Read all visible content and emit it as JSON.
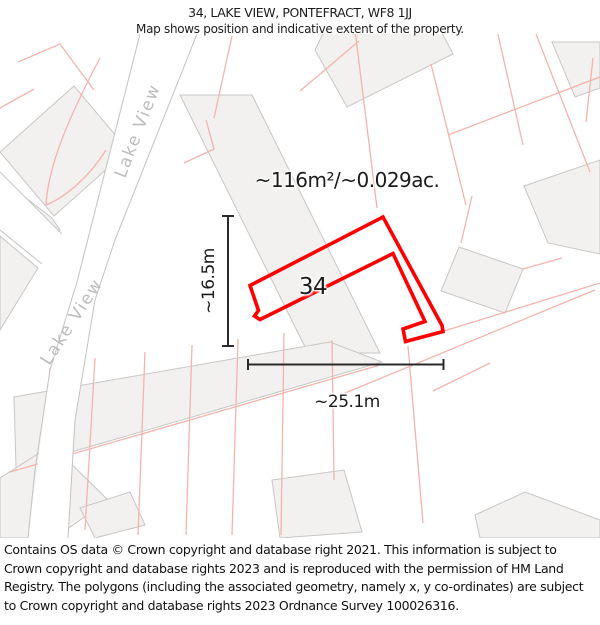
{
  "header": {
    "line1": "34, LAKE VIEW, PONTEFRACT, WF8 1JJ",
    "line2": "Map shows position and indicative extent of the property."
  },
  "map": {
    "area_label": "~116m²/~0.029ac.",
    "plot_number": "34",
    "height_label": "~16.5m",
    "width_label": "~25.1m",
    "street_labels": [
      "Lake View",
      "Lake View"
    ],
    "colors": {
      "property_outline": "#ff0000",
      "parcel_line": "#f5b3ad",
      "building_fill": "#f2f1ef",
      "building_stroke": "#c9c7c5",
      "dimension_line": "#2a2a2a",
      "street_label": "#bdbdbd"
    }
  },
  "footer": {
    "text": "Contains OS data © Crown copyright and database right 2021. This information is subject to Crown copyright and database rights 2023 and is reproduced with the permission of HM Land Registry. The polygons (including the associated geometry, namely x, y co-ordinates) are subject to Crown copyright and database rights 2023 Ordnance Survey 100026316."
  }
}
